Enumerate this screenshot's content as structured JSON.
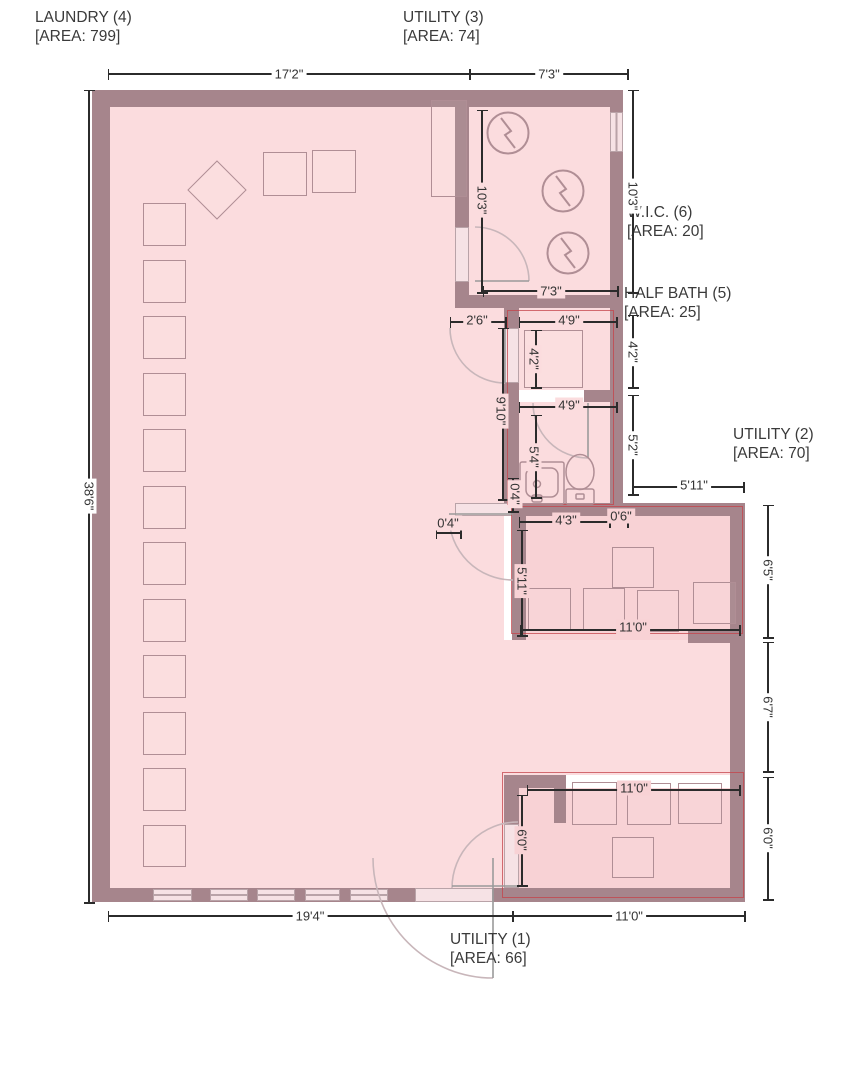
{
  "rooms": [
    {
      "name": "LAUNDRY (4)",
      "area": "[AREA: 799]",
      "x": 35,
      "y": 8
    },
    {
      "name": "UTILITY (3)",
      "area": "[AREA: 74]",
      "x": 403,
      "y": 8
    },
    {
      "name": "W.I.C. (6)",
      "area": "[AREA: 20]",
      "x": 627,
      "y": 203
    },
    {
      "name": "HALF BATH (5)",
      "area": "[AREA: 25]",
      "x": 624,
      "y": 284
    },
    {
      "name": "UTILITY (2)",
      "area": "[AREA: 70]",
      "x": 733,
      "y": 425
    },
    {
      "name": "UTILITY (1)",
      "area": "[AREA: 66]",
      "x": 450,
      "y": 930
    }
  ],
  "dimensions": [
    {
      "text": "17'2\"",
      "orient": "h",
      "x1": 108,
      "y1": 74,
      "x2": 470,
      "y2": 74,
      "lx": 289,
      "ly": 74,
      "bg": "w"
    },
    {
      "text": "7'3\"",
      "orient": "h",
      "x1": 470,
      "y1": 74,
      "x2": 628,
      "y2": 74,
      "lx": 549,
      "ly": 74,
      "bg": "w"
    },
    {
      "text": "38'6\"",
      "orient": "v",
      "x1": 89,
      "y1": 90,
      "x2": 89,
      "y2": 903,
      "lx": 89,
      "ly": 496,
      "bg": "w"
    },
    {
      "text": "19'4\"",
      "orient": "h",
      "x1": 108,
      "y1": 916,
      "x2": 513,
      "y2": 916,
      "lx": 310,
      "ly": 916,
      "bg": "w"
    },
    {
      "text": "11'0\"",
      "orient": "h",
      "x1": 513,
      "y1": 916,
      "x2": 745,
      "y2": 916,
      "lx": 629,
      "ly": 916,
      "bg": "w"
    },
    {
      "text": "10'3\"",
      "orient": "v",
      "x1": 482,
      "y1": 110,
      "x2": 482,
      "y2": 293,
      "lx": 482,
      "ly": 200,
      "bg": "p"
    },
    {
      "text": "10'3\"",
      "orient": "v",
      "x1": 633,
      "y1": 90,
      "x2": 633,
      "y2": 293,
      "lx": 633,
      "ly": 196,
      "bg": "w"
    },
    {
      "text": "7'3\"",
      "orient": "h",
      "x1": 483,
      "y1": 291,
      "x2": 618,
      "y2": 291,
      "lx": 551,
      "ly": 291,
      "bg": "p"
    },
    {
      "text": "2'6\"",
      "orient": "h",
      "x1": 450,
      "y1": 322,
      "x2": 506,
      "y2": 322,
      "lx": 477,
      "ly": 320,
      "bg": "p"
    },
    {
      "text": "4'9\"",
      "orient": "h",
      "x1": 519,
      "y1": 322,
      "x2": 617,
      "y2": 322,
      "lx": 569,
      "ly": 320,
      "bg": "p"
    },
    {
      "text": "4'2\"",
      "orient": "v",
      "x1": 536,
      "y1": 330,
      "x2": 536,
      "y2": 388,
      "lx": 534,
      "ly": 359,
      "bg": "p"
    },
    {
      "text": "4'2\"",
      "orient": "v",
      "x1": 633,
      "y1": 315,
      "x2": 633,
      "y2": 388,
      "lx": 633,
      "ly": 352,
      "bg": "w"
    },
    {
      "text": "9'10\"",
      "orient": "v",
      "x1": 503,
      "y1": 328,
      "x2": 503,
      "y2": 500,
      "lx": 501,
      "ly": 411,
      "bg": "p"
    },
    {
      "text": "4'9\"",
      "orient": "h",
      "x1": 519,
      "y1": 407,
      "x2": 617,
      "y2": 407,
      "lx": 569,
      "ly": 405,
      "bg": "p"
    },
    {
      "text": "5'4\"",
      "orient": "v",
      "x1": 536,
      "y1": 415,
      "x2": 536,
      "y2": 498,
      "lx": 534,
      "ly": 457,
      "bg": "p"
    },
    {
      "text": "5'2\"",
      "orient": "v",
      "x1": 633,
      "y1": 395,
      "x2": 633,
      "y2": 495,
      "lx": 633,
      "ly": 445,
      "bg": "w"
    },
    {
      "text": "5'11\"",
      "orient": "h",
      "x1": 633,
      "y1": 487,
      "x2": 744,
      "y2": 487,
      "lx": 694,
      "ly": 485,
      "bg": "w"
    },
    {
      "text": "0'4\"",
      "orient": "v",
      "x1": 513,
      "y1": 478,
      "x2": 513,
      "y2": 512,
      "lx": 515,
      "ly": 494,
      "bg": "p"
    },
    {
      "text": "4'3\"",
      "orient": "h",
      "x1": 519,
      "y1": 522,
      "x2": 610,
      "y2": 522,
      "lx": 566,
      "ly": 520,
      "bg": "d"
    },
    {
      "text": "0'6\"",
      "orient": "h",
      "x1": 610,
      "y1": 522,
      "x2": 628,
      "y2": 522,
      "lx": 621,
      "ly": 516,
      "bg": "d"
    },
    {
      "text": "0'4\"",
      "orient": "h",
      "x1": 436,
      "y1": 533,
      "x2": 461,
      "y2": 533,
      "lx": 448,
      "ly": 523,
      "bg": "p"
    },
    {
      "text": "5'11\"",
      "orient": "v",
      "x1": 522,
      "y1": 530,
      "x2": 522,
      "y2": 636,
      "lx": 522,
      "ly": 581,
      "bg": "d"
    },
    {
      "text": "11'0\"",
      "orient": "h",
      "x1": 520,
      "y1": 630,
      "x2": 740,
      "y2": 630,
      "lx": 633,
      "ly": 627,
      "bg": "d"
    },
    {
      "text": "6'5\"",
      "orient": "v",
      "x1": 768,
      "y1": 505,
      "x2": 768,
      "y2": 638,
      "lx": 768,
      "ly": 570,
      "bg": "w"
    },
    {
      "text": "6'7\"",
      "orient": "v",
      "x1": 768,
      "y1": 642,
      "x2": 768,
      "y2": 772,
      "lx": 768,
      "ly": 707,
      "bg": "w"
    },
    {
      "text": "6'0\"",
      "orient": "v",
      "x1": 768,
      "y1": 777,
      "x2": 768,
      "y2": 900,
      "lx": 768,
      "ly": 838,
      "bg": "w"
    },
    {
      "text": "11'0\"",
      "orient": "h",
      "x1": 527,
      "y1": 790,
      "x2": 740,
      "y2": 790,
      "lx": 634,
      "ly": 788,
      "bg": "d"
    },
    {
      "text": "6'0\"",
      "orient": "v",
      "x1": 522,
      "y1": 795,
      "x2": 522,
      "y2": 886,
      "lx": 522,
      "ly": 840,
      "bg": "d"
    }
  ],
  "colors": {
    "wall": "#a6858c",
    "floor": "#fbdcde",
    "floor_deep": "#f8d2d5",
    "highlight_red": "#c4434a",
    "dimension_line": "#2b2b2b",
    "label_text": "#3a3a3a",
    "fixture_outline": "#b08e95"
  }
}
